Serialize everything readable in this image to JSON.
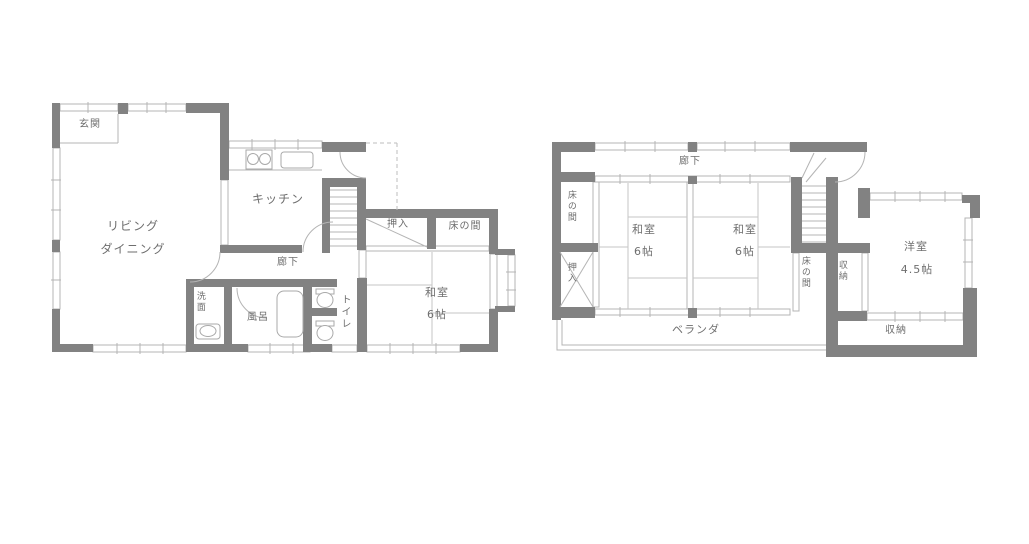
{
  "page": {
    "type": "floor-plan-drawing",
    "background": "#ffffff"
  },
  "colors": {
    "wall": "#828282",
    "thin_line": "#b4b4b4",
    "tatami_line": "#c6c6c6",
    "text": "#6e6e6e"
  },
  "floor1": {
    "labels": {
      "entrance": "玄関",
      "living_line1": "リビング",
      "living_line2": "ダイニング",
      "kitchen": "キッチン",
      "hallway": "廊下",
      "closet": "押入",
      "tokonoma": "床の間",
      "washroom": "洗面",
      "bath": "風呂",
      "toilet": "トイレ",
      "japanese_room": "和室",
      "japanese_room_size": "6帖"
    }
  },
  "floor2": {
    "labels": {
      "hallway": "廊下",
      "tokonoma_left": "床の間",
      "closet_left": "押入",
      "japanese_room_1": "和室",
      "japanese_room_1_size": "6帖",
      "japanese_room_2": "和室",
      "japanese_room_2_size": "6帖",
      "tokonoma_center": "床の間",
      "storage_center": "収納",
      "western_room": "洋室",
      "western_room_size": "4.5帖",
      "storage_bottom": "収納",
      "veranda": "ベランダ"
    }
  }
}
